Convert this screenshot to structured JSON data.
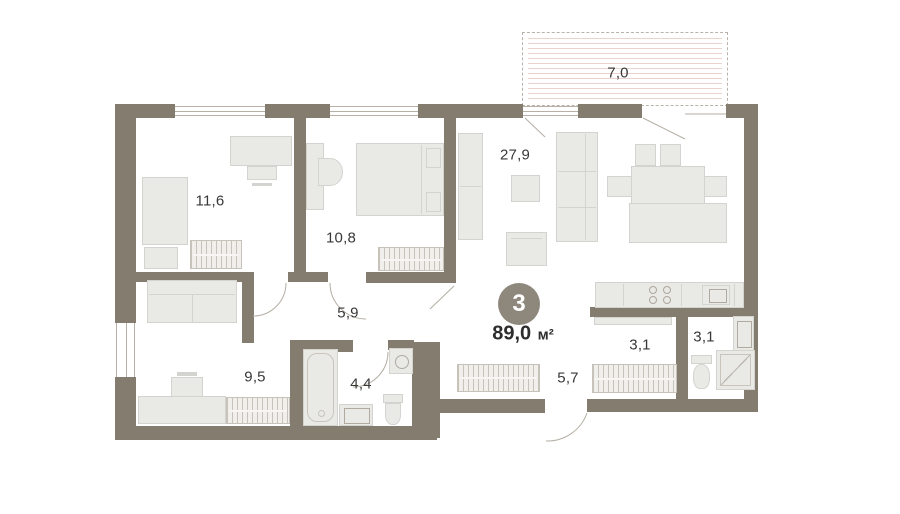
{
  "plan": {
    "title": "apartment-floor-plan",
    "badge": {
      "rooms_count": "3",
      "area_value": "89,0",
      "area_unit": "м²"
    },
    "rooms": [
      {
        "id": "bedroom-1",
        "area": "11,6"
      },
      {
        "id": "bedroom-2",
        "area": "10,8"
      },
      {
        "id": "living-kitchen",
        "area": "27,9"
      },
      {
        "id": "balcony",
        "area": "7,0"
      },
      {
        "id": "hallway",
        "area": "5,9"
      },
      {
        "id": "bedroom-3",
        "area": "9,5"
      },
      {
        "id": "bathroom",
        "area": "4,4"
      },
      {
        "id": "corridor",
        "area": "5,7"
      },
      {
        "id": "pantry",
        "area": "3,1"
      },
      {
        "id": "wc",
        "area": "3,1"
      }
    ],
    "colors": {
      "wall": "#847c6e",
      "furniture_fill": "#e9e9e6",
      "badge_bg": "#8e877b",
      "balcony_hatch": "#e8d4cd",
      "text": "#383838"
    }
  }
}
